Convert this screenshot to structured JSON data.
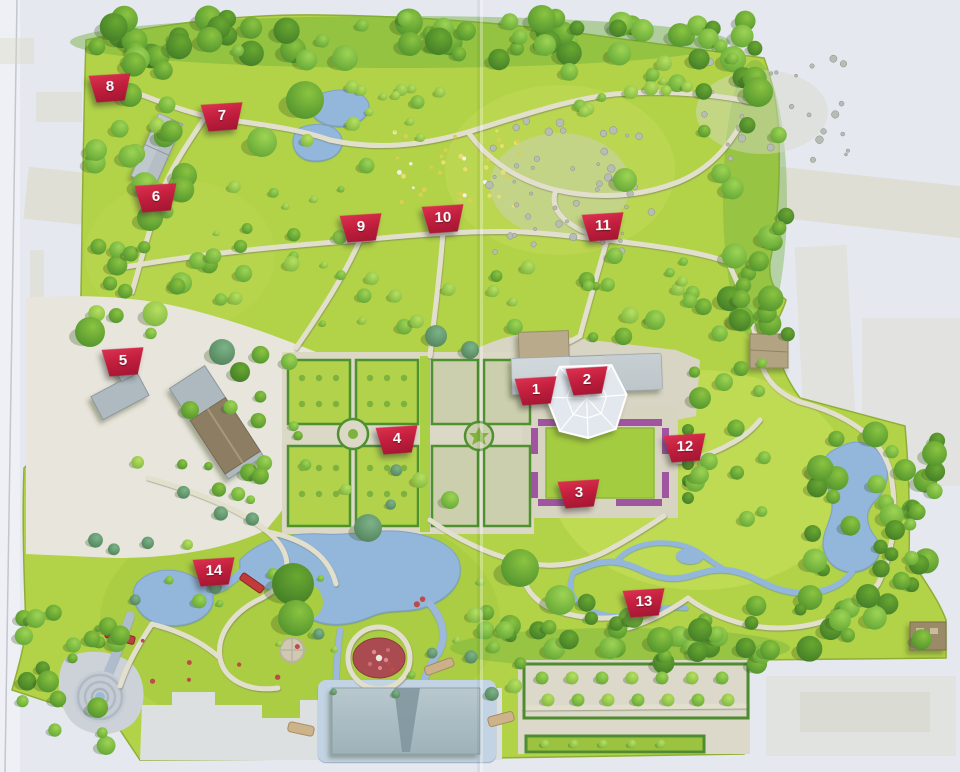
{
  "map": {
    "markers": [
      {
        "number": "1",
        "x": 536,
        "y": 391
      },
      {
        "number": "2",
        "x": 587,
        "y": 381
      },
      {
        "number": "3",
        "x": 579,
        "y": 494
      },
      {
        "number": "4",
        "x": 397,
        "y": 440
      },
      {
        "number": "5",
        "x": 123,
        "y": 362
      },
      {
        "number": "6",
        "x": 156,
        "y": 198
      },
      {
        "number": "7",
        "x": 222,
        "y": 117
      },
      {
        "number": "8",
        "x": 110,
        "y": 88
      },
      {
        "number": "9",
        "x": 361,
        "y": 228
      },
      {
        "number": "10",
        "x": 443,
        "y": 219
      },
      {
        "number": "11",
        "x": 603,
        "y": 227
      },
      {
        "number": "12",
        "x": 685,
        "y": 448
      },
      {
        "number": "13",
        "x": 644,
        "y": 603
      },
      {
        "number": "14",
        "x": 214,
        "y": 572
      }
    ],
    "colors": {
      "marker_red": "#c31f3e",
      "park_green": "#b2d348",
      "tree_green": "#5ea233",
      "water_blue": "#92b6dc",
      "path_tan": "#e2dfcd",
      "pavement": "#e8e6dc",
      "background": "#e5e8ef"
    }
  }
}
